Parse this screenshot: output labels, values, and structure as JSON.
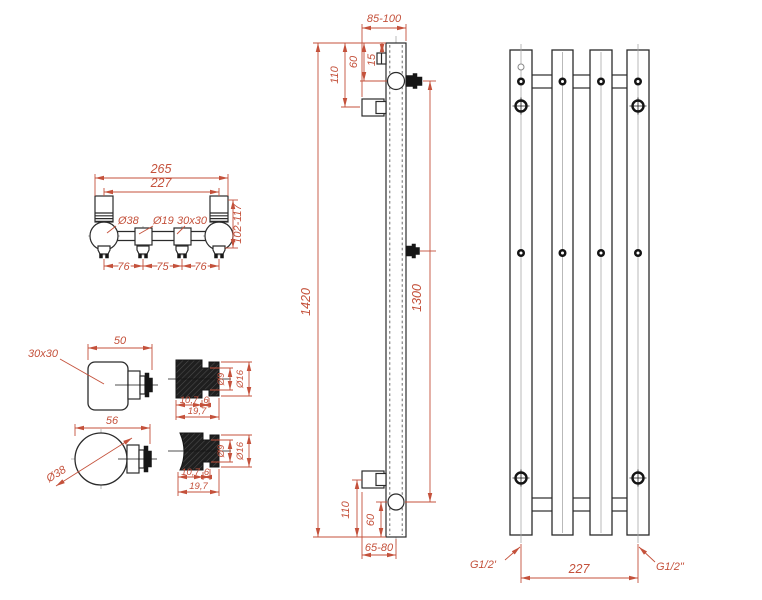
{
  "title": "towel-radiator-technical-drawing",
  "colors": {
    "dimension": "#c4513b",
    "outline": "#2b2b2b",
    "centerline": "#a8a8a8",
    "section_fill": "#161616"
  },
  "top_view": {
    "overall_width": "265",
    "connection_spacing": "227",
    "tube_diameter": "Ø38",
    "pipe_diameter": "Ø19",
    "square_profile": "30x30",
    "depth_range": "102-117",
    "spacing": [
      "76",
      "75",
      "76"
    ]
  },
  "side_view": {
    "wall_distance_top": "85-100",
    "top_bracket_offset": "110",
    "top_connection_offset": "60",
    "top_vent_offset": "15",
    "total_height": "1420",
    "connection_height": "1300",
    "bottom_bracket_offset": "110",
    "bottom_connection_offset": "60",
    "wall_distance_bottom": "65-80"
  },
  "front_view": {
    "thread_left": "G1/2'",
    "thread_right": "G1/2\"",
    "connection_width": "227"
  },
  "details": {
    "square_tube": {
      "profile": "30x30",
      "length": "50"
    },
    "round_tube": {
      "diameter": "Ø38",
      "length": "56"
    },
    "section_a": {
      "inner": "Ø9",
      "outer": "Ø16",
      "len_a": "10,7",
      "len_b": "6",
      "total": "19,7"
    },
    "section_b": {
      "inner": "Ø9",
      "outer": "Ø16",
      "len_a": "10,7",
      "len_b": "6",
      "total": "19,7"
    }
  }
}
